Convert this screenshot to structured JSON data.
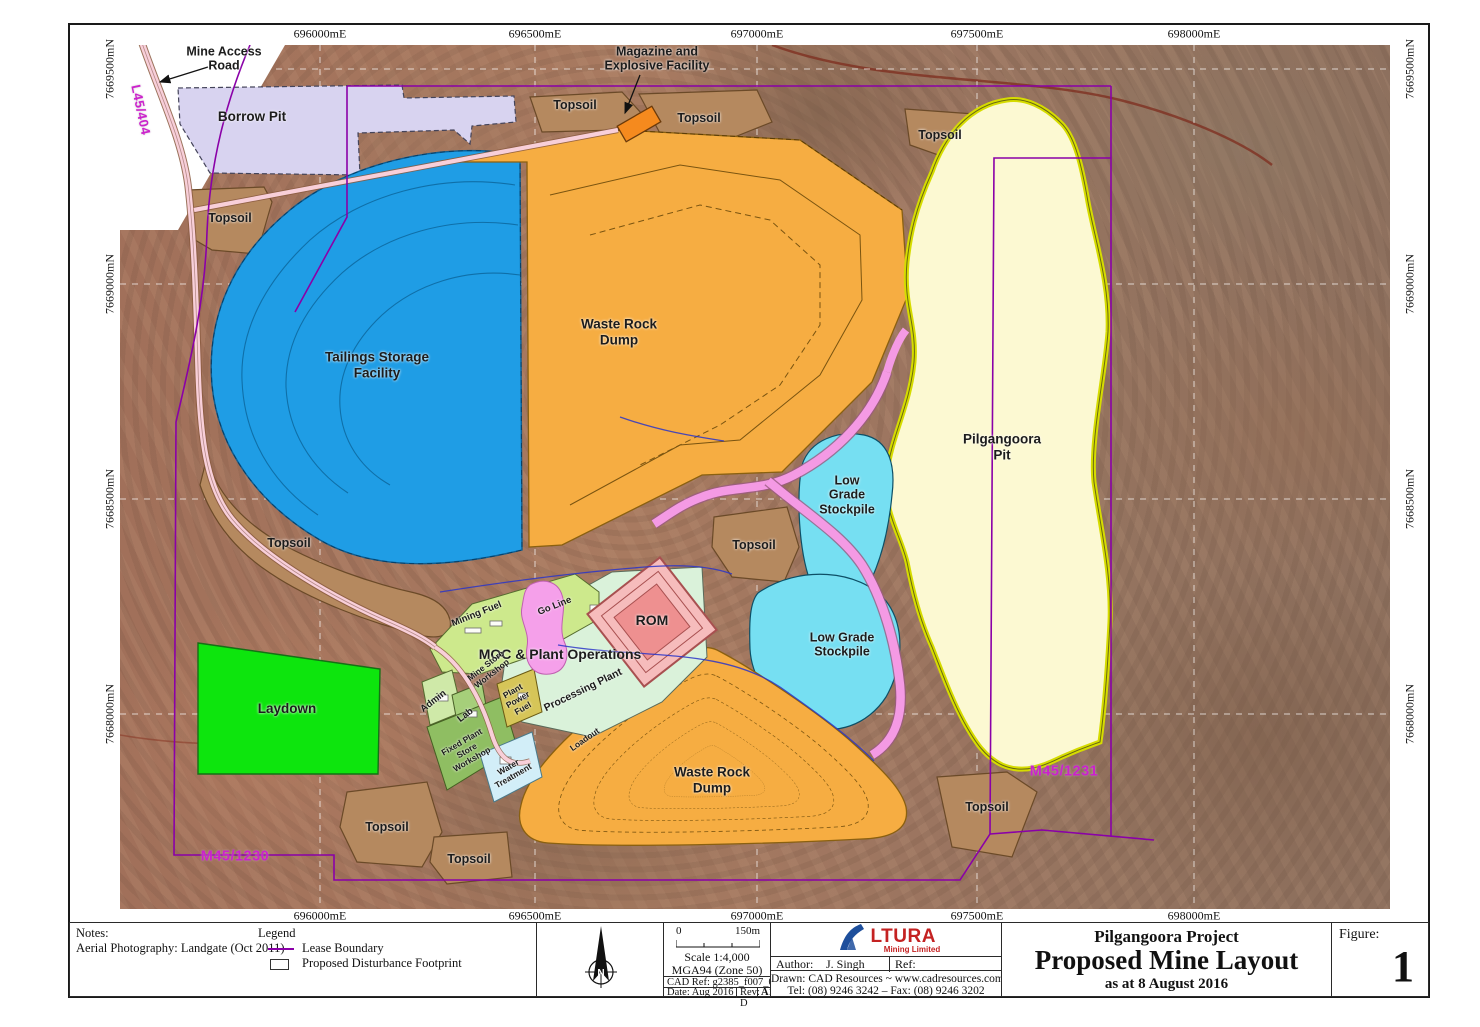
{
  "sheet": {
    "grid_top": [
      "696000mE",
      "696500mE",
      "697000mE",
      "697500mE",
      "698000mE"
    ],
    "grid_bottom": [
      "696000mE",
      "696500mE",
      "697000mE",
      "697500mE",
      "698000mE"
    ],
    "grid_left": [
      "7669500mN",
      "7669000mN",
      "7668500mN",
      "7668000mN"
    ],
    "grid_right": [
      "7669500mN",
      "7669000mN",
      "7668500mN",
      "7668000mN"
    ]
  },
  "map": {
    "labels": {
      "mine_access_road": "Mine Access\nRoad",
      "magazine": "Magazine and\nExplosive Facility",
      "borrow_pit": "Borrow Pit",
      "topsoil": "Topsoil",
      "tsf": "Tailings Storage\nFacility",
      "waste_rock_dump": "Waste Rock\nDump",
      "pilgangoora_pit": "Pilgangoora\nPit",
      "low_grade_stockpile_3line": "Low\nGrade\nStockpile",
      "low_grade_stockpile_2line": "Low Grade\nStockpile",
      "moc": "MOC & Plant Operations",
      "rom": "ROM",
      "mining_fuel": "Mining Fuel",
      "go_line": "Go Line",
      "mine_store_workshop": "Mine Store\nWorkshop",
      "admin": "Admin",
      "lab": "Lab",
      "fixed_plant_store_workshop": "Fixed Plant\nStore\nWorkshop",
      "plant_power_fuel": "Plant\nPower\nFuel",
      "water_treatment": "Water\nTreatment",
      "processing_plant": "Processing Plant",
      "loadout": "Loadout",
      "laydown": "Laydown",
      "m45_1230": "M45/1230",
      "m45_1231": "M45/1231",
      "l45_404": "L45/404"
    }
  },
  "titleblock": {
    "notes_title": "Notes:",
    "notes_body": "Aerial Photography: Landgate (Oct 2011)",
    "legend_title": "Legend",
    "legend_lease": "Lease Boundary",
    "legend_footprint": "Proposed Disturbance Footprint",
    "north": "N",
    "scale_zero": "0",
    "scale_max": "150m",
    "scale_text": "Scale 1:4,000",
    "datum": "MGA94 (Zone 50)",
    "cad_ref": "CAD Ref: g2385_f007_01.dgn",
    "date": "Date: Aug 2016",
    "rev": "Rev: D",
    "sheet_size": "A1",
    "logo_text": "LTURA",
    "logo_sub": "Mining Limited",
    "author_label": "Author:",
    "author": "J. Singh",
    "ref_label": "Ref:",
    "drawn": "Drawn:  CAD Resources ~ www.cadresources.com.au",
    "tel": "Tel: (08) 9246 3242 – Fax: (08) 9246 3202",
    "project": "Pilgangoora Project",
    "title": "Proposed Mine Layout",
    "subtitle": "as at 8 August 2016",
    "figure_label": "Figure:",
    "figure_number": "1"
  },
  "colors": {
    "lease_boundary": "#8a00a8",
    "tsf_blue": "#1f9de5",
    "waste_rock_orange": "#f6ad42",
    "pit_yellow": "#fcf9d2",
    "stockpile_cyan": "#76dff2",
    "laydown_green": "#0de50d",
    "topsoil_brown": "#b5895f",
    "borrow_pit_lavender": "#d8d3f0",
    "haul_road_pink": "#f49ae4",
    "road_pink": "#f8cfd9"
  }
}
